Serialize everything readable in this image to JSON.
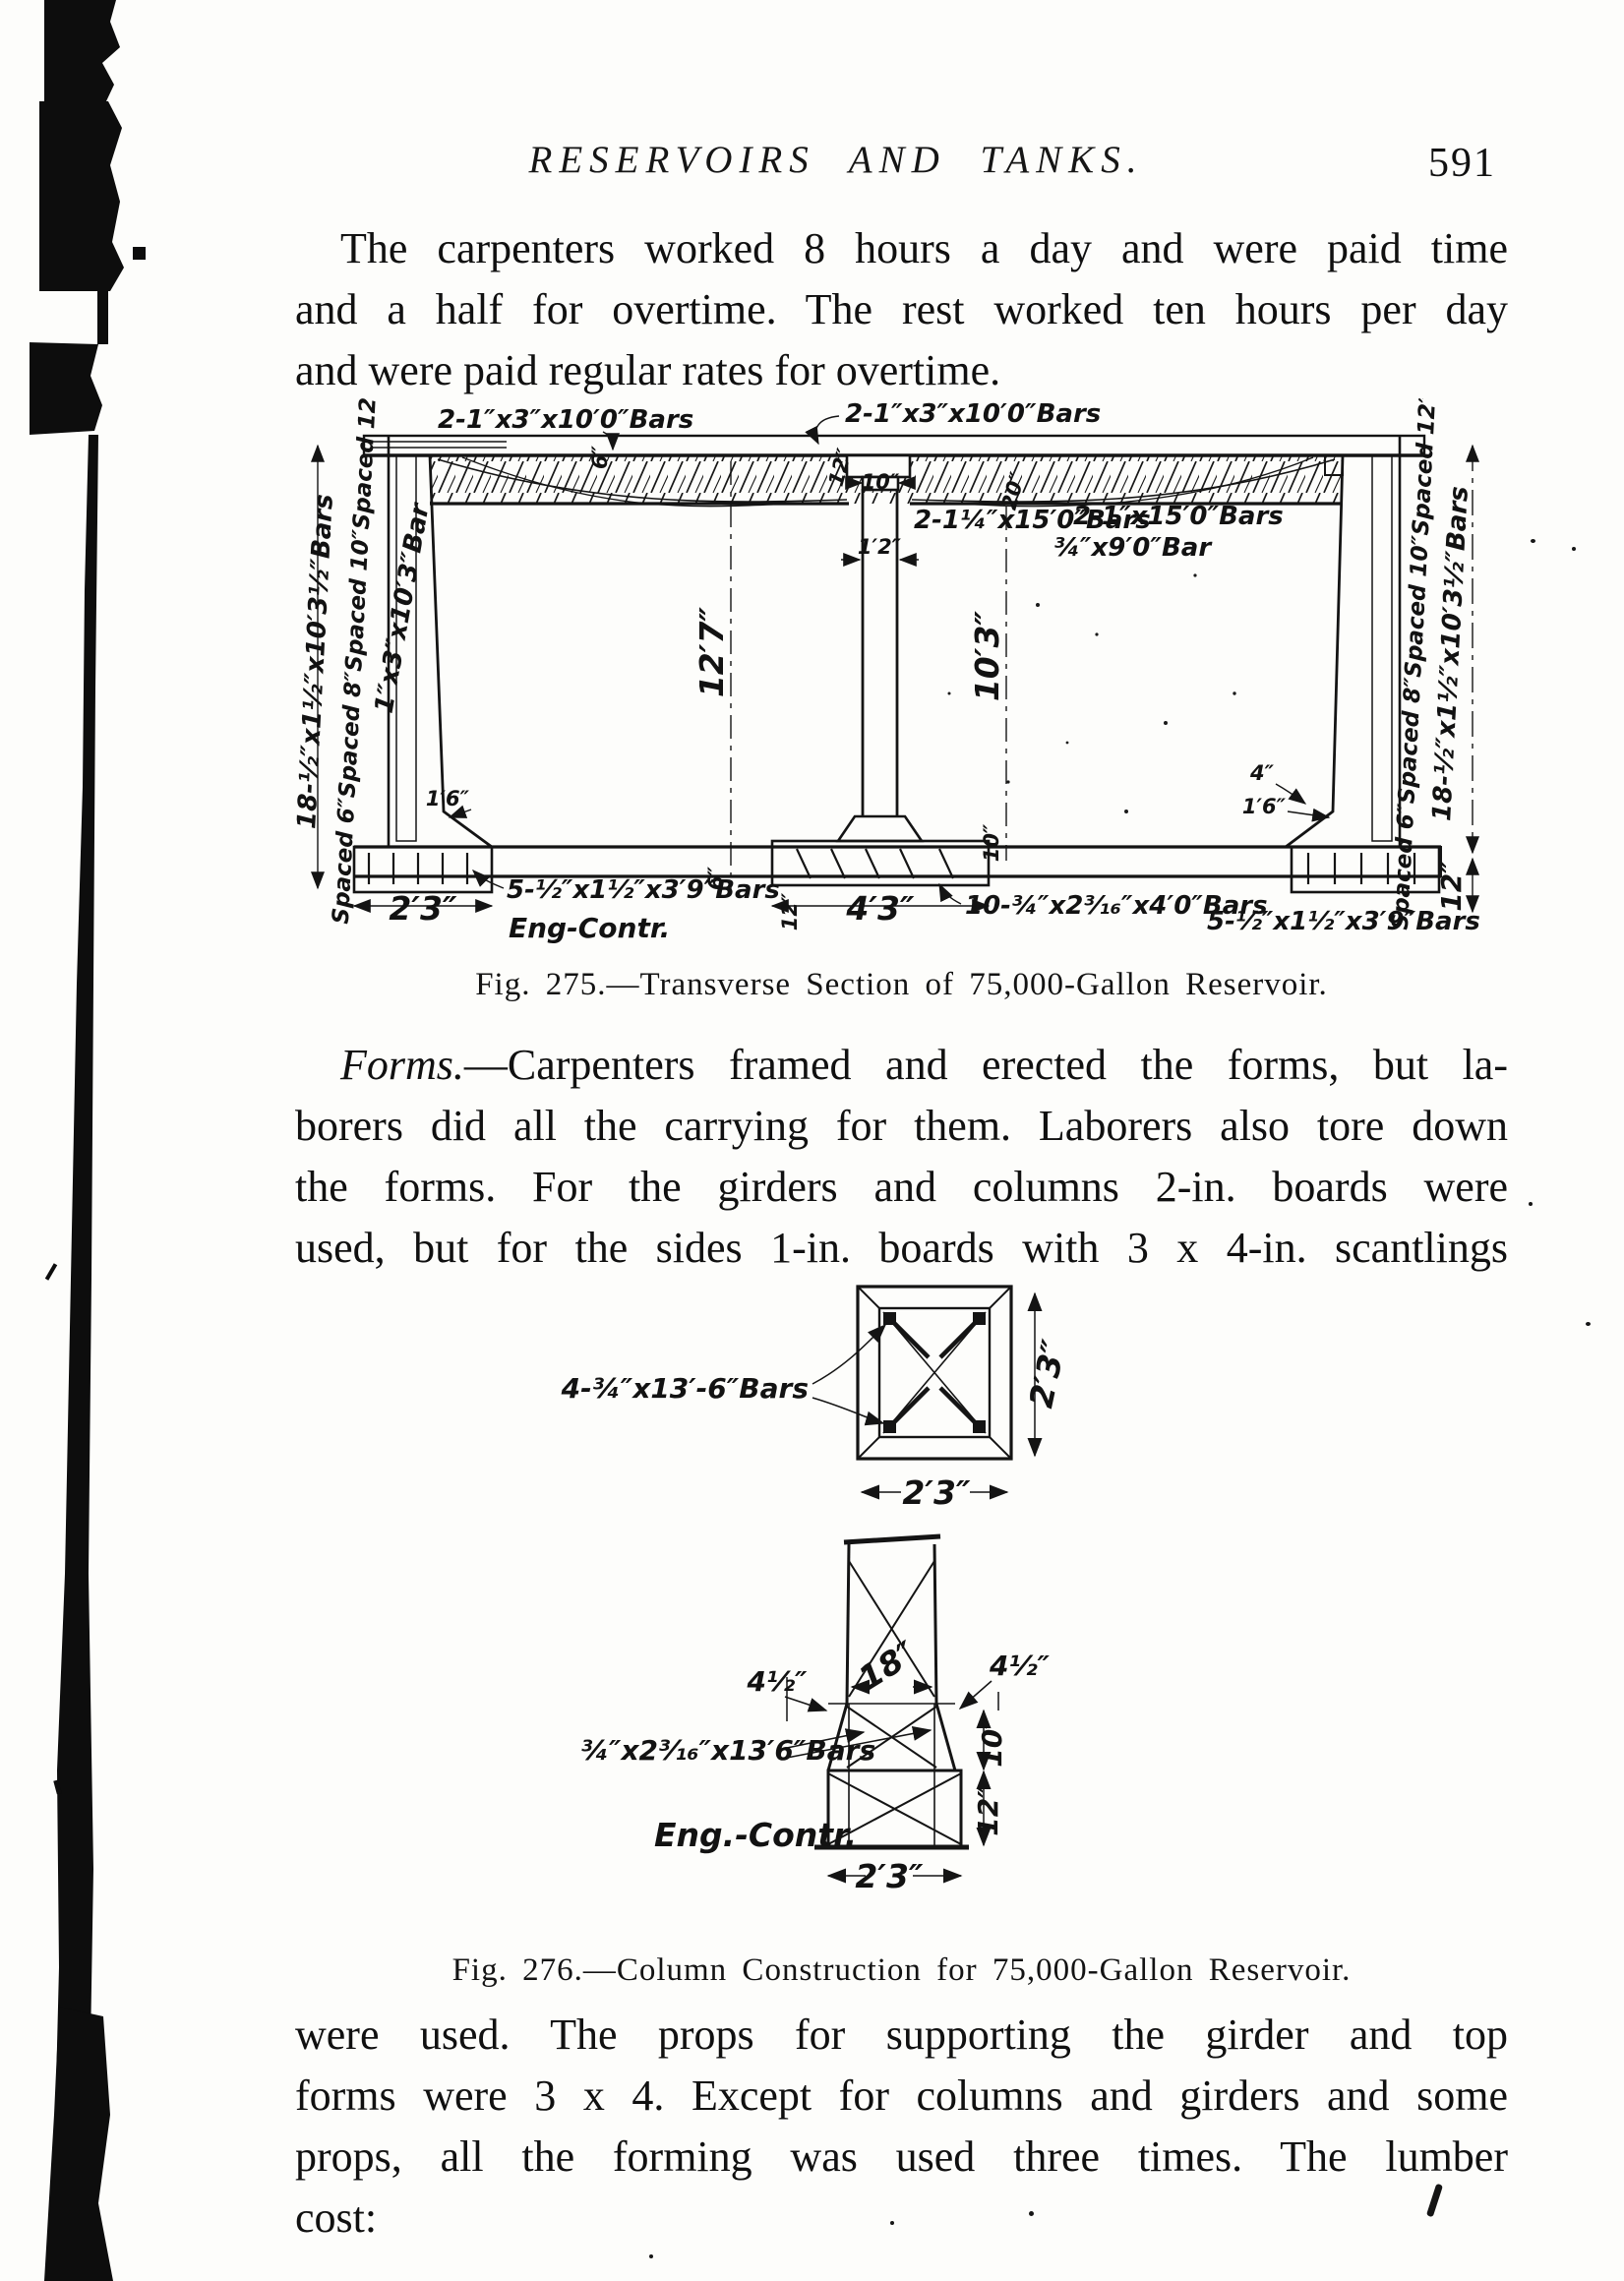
{
  "header": {
    "title": "RESERVOIRS AND TANKS.",
    "page_number": "591"
  },
  "para1": {
    "lines": [
      "The carpenters worked 8 hours a day and were paid time",
      "and a half for overtime.  The rest worked ten hours per day",
      "and were paid regular rates for overtime."
    ]
  },
  "fig275": {
    "caption": "Fig. 275.—Transverse Section of 75,000-Gallon Reservoir.",
    "labels": {
      "top_left_bars": "2-1″x3″x10′0″Bars",
      "top_right_bars": "2-1″x3″x10′0″Bars",
      "girder_left_bars": "2-1¼″x15′0″Bars",
      "girder_right_bars": "2-1″x15′0″Bars",
      "girder_right_bar2": "¾″x9′0″Bar",
      "left_wall_bars": "18-½″x1½″x10′3½″Bars",
      "left_wall_spacing": "Spaced 6″Spaced 8″Spaced 10″Spaced 12″",
      "left_wall_bar": "1″x3″x10′3″Bar",
      "right_wall_spacing": "Spaced 6″Spaced 8″Spaced 10″Spaced 12″",
      "right_wall_bars": "18-½″x1½″x10′3½″Bars",
      "height_left": "12′7″",
      "height_right": "10′3″",
      "column_width": "1′2″",
      "wall_base_left": "1′6″",
      "wall_base_right": "1′6″",
      "wall_top_right": "4″",
      "footing_left_width": "2′3″",
      "footing_center_width": "4′3″",
      "floor_bars_left": "5-½″x1½″x3′9″Bars",
      "floor_bars_center": "10-¾″x2³⁄₁₆″x4′0″Bars",
      "floor_bars_right": "5-½″x1½″x3′9″Bars",
      "credit": "Eng-Contr.",
      "slab_thickness": "6″",
      "drop_width": "12″",
      "girder_depth": "20″",
      "stub_width": "10″",
      "floor_thickness_left": "6″",
      "pedestal_height": "10″",
      "floor_thickness_center": "12″",
      "floor_thickness_right": "12″"
    }
  },
  "para2": {
    "lead_italic": "Forms.",
    "line1_rest": "—Carpenters framed and erected the forms, but la-",
    "lines": [
      "borers did all the carrying for them.  Laborers also tore down",
      "the forms.  For the girders and columns 2-in. boards were",
      "used, but for the sides 1-in. boards with 3 x 4-in. scantlings"
    ]
  },
  "fig276": {
    "caption": "Fig. 276.—Column Construction for 75,000-Gallon Reservoir.",
    "labels": {
      "plan_bars": "4-¾″x13′-6″Bars",
      "plan_dim_right": "2′3″",
      "plan_dim_bottom": "2′3″",
      "column_width": "18″",
      "offset_left": "4½″",
      "offset_right": "4½″",
      "flare_height": "10″",
      "base_height": "12″",
      "base_width": "2′3″",
      "elev_bars": "¾″x2³⁄₁₆″x13′6″Bars",
      "credit": "Eng.-Contr."
    }
  },
  "para3": {
    "lines": [
      "were used.  The props for supporting the girder and top",
      "forms were 3 x 4.  Except for columns and girders and some",
      "props, all the forming was used three times.  The lumber",
      "cost:"
    ]
  }
}
